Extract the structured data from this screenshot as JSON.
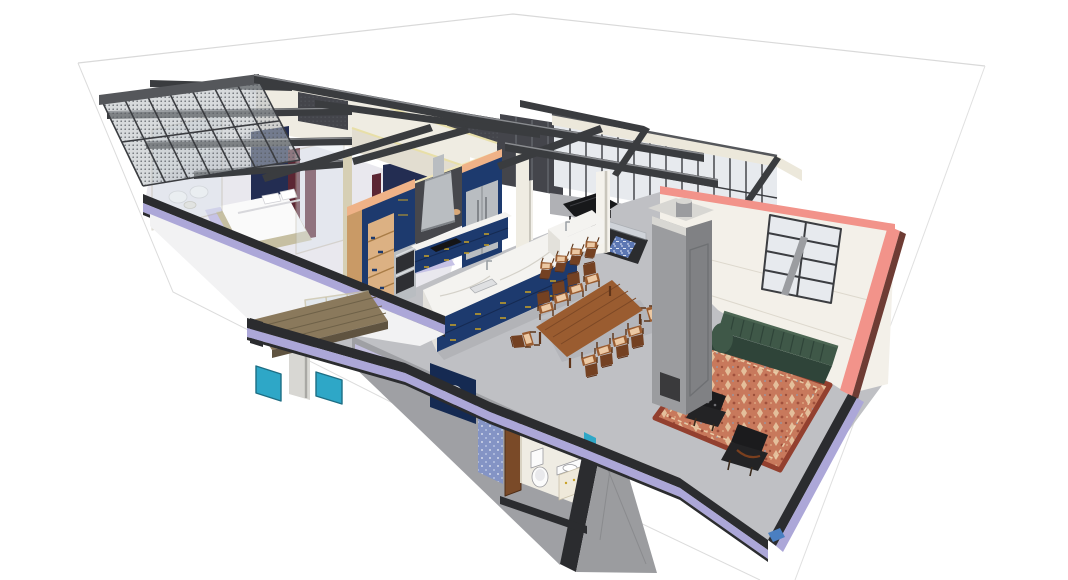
{
  "meta": {
    "type": "3d-architectural-cutaway-render",
    "style": "sketchup-like dollhouse section view",
    "canvas": {
      "width": 1068,
      "height": 580
    },
    "background": "#ffffff",
    "description": "Isometric cutaway view of a two-story loft: bedrooms at left, blue kitchen with marble island at center, dining table, concrete fireplace chimney, green sofa on oriental rug at right, bathroom and laundry on the lower level"
  },
  "palette": {
    "groundLine": "#d9d9d9",
    "steelDark": "#3a3c3f",
    "steelMid": "#55575b",
    "steelLight": "#8a8c90",
    "fascia": "#ece8db",
    "fasciaEdge": "#b9b4a2",
    "soffit": "#eef0f2",
    "glass": "#e7eaee",
    "glassDoor": "#dde4ea",
    "mullion": "#3b3d41",
    "mesh": "#b7bbc0",
    "meshDot": "#585c62",
    "darkPanel": "#44454b",
    "wallCream": "#efece2",
    "wallCream2": "#e2ddd0",
    "khaki": "#d6cfb4",
    "warmLight": "#f0e6b8",
    "accentNavy": "#232d52",
    "curtain": "#5c2633",
    "floorBedroom": "#e9e8ee",
    "lavender": "#aca7d8",
    "lavenderLight": "#c6c2e6",
    "bedBase": "#c6bfa2",
    "white": "#fafafa",
    "navy": "#1d3a6e",
    "navyDark": "#152a52",
    "navyLight": "#2c4f93",
    "peach": "#efb287",
    "woodShelf": "#c99a66",
    "woodShelfLight": "#dcb183",
    "stainless": "#b9bdc1",
    "stainlessDark": "#8f9398",
    "backsplash": "#46474c",
    "marble": "#f4f3f0",
    "marbleShadow": "#e3e1db",
    "marbleVein": "#d4d1c9",
    "floorUpper": "#bfc0c4",
    "floorLower": "#9fa0a4",
    "slabDark": "#2b2c2f",
    "concrete": "#9b9c9f",
    "concreteDark": "#808184",
    "concreteLight": "#d8d7d3",
    "woodTable": "#9a5c30",
    "woodDark": "#744122",
    "cushion": "#ecc9a4",
    "sofa": "#3f5848",
    "sofaDark": "#2f4439",
    "rugBase": "#c8795c",
    "rugBorder": "#93402f",
    "rugCream": "#e9cba6",
    "wallWhite": "#f3f0e9",
    "pink": "#f2938a",
    "pinkDark": "#6e3c34",
    "teal": "#2ea7c7",
    "blueAccent": "#4a7fc1",
    "deck": "#8a795c",
    "deckDark": "#5f5340",
    "bath": "#efece3",
    "fixture": "#fbfbfb",
    "wallpaper": "#8494c5",
    "runner": "#5c77b3",
    "brass": "#c9a227",
    "piano": "#17181a",
    "black": "#1b1b1d",
    "shadow": "#5a5b5e"
  },
  "scene": {
    "upper_floor": {
      "rooms": [
        {
          "name": "bedroom-1",
          "contents": [
            "bed",
            "navy-headboard-wall",
            "maroon-curtains",
            "glass-partition",
            "seating-nook"
          ]
        },
        {
          "name": "bedroom-2",
          "contents": [
            "bed",
            "navy-headboard-wall",
            "maroon-curtains"
          ]
        },
        {
          "name": "kitchen",
          "contents": [
            "pantry-shelf-unit",
            "double-wall-oven",
            "range-hood",
            "dark-backsplash",
            "refrigerator-cabinet",
            "base-cabinets",
            "cooktop",
            "marble-island",
            "raised-bar-counter",
            "bar-stools",
            "faucets"
          ]
        },
        {
          "name": "dining-area",
          "contents": [
            "wood-dining-table",
            "dining-chairs"
          ]
        },
        {
          "name": "living-room",
          "contents": [
            "green-tufted-sofa",
            "oriental-rug",
            "black-lounge-chairs",
            "white-wall-with-window",
            "pink-section-cut-edge"
          ]
        },
        {
          "name": "music-corner",
          "contents": [
            "grand-piano",
            "stairwell-opening",
            "patterned-stair-runner"
          ]
        }
      ],
      "counts": {
        "beds": 2,
        "dining_chairs": 10,
        "bar_stools": 4,
        "lounge_chairs": 2
      }
    },
    "lower_floor": {
      "rooms": [
        {
          "name": "bathroom",
          "contents": [
            "toilet",
            "vanity-sink"
          ]
        },
        {
          "name": "laundry",
          "contents": [
            "washer",
            "navy-cabinet",
            "blue-wallpaper-wall",
            "wood-door"
          ]
        },
        {
          "name": "terrace",
          "contents": [
            "wood-deck",
            "glass-sliding-doors",
            "teal-glass-panels"
          ]
        }
      ]
    },
    "structure": [
      "steel-i-beams",
      "mesh-screen-curtain-wall",
      "glazed-pavilion",
      "white-columns",
      "concrete-fireplace-chimney",
      "floor-slab-lavender-edge-bands",
      "concrete-piers",
      "ground-plane-outline"
    ]
  }
}
